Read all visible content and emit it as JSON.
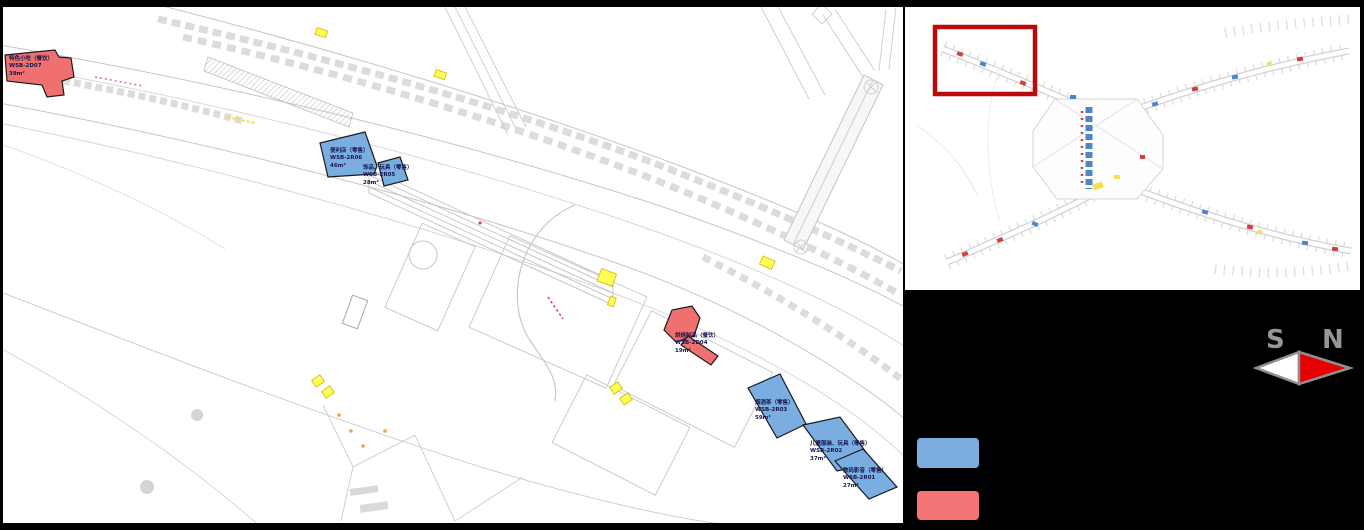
{
  "plan": {
    "shops": [
      {
        "name": "特色小吃（餐饮）",
        "code": "WSB-2D07",
        "area": "39m²",
        "category": "dining"
      },
      {
        "name": "便利店（零售）",
        "code": "WSB-2R06",
        "area": "46m²",
        "category": "retail"
      },
      {
        "name": "饰品、玩具（零售）",
        "code": "WSB-2R05",
        "area": "28m²",
        "category": "retail"
      },
      {
        "name": "烘焙制品（餐饮）",
        "code": "WSB-2D04",
        "area": "19m²",
        "category": "dining"
      },
      {
        "name": "烟酒茶（零售）",
        "code": "WSB-2R03",
        "area": "59m²",
        "category": "retail"
      },
      {
        "name": "儿童服装、玩具（零售）",
        "code": "WSB-2R02",
        "area": "37m²",
        "category": "retail"
      },
      {
        "name": "数码影音（零售）",
        "code": "WSB-2R01",
        "area": "27m²",
        "category": "retail"
      }
    ]
  },
  "compass": {
    "south_label": "S",
    "north_label": "N"
  },
  "legend": {
    "items": [
      {
        "key": "retail",
        "color": "#7BADDE"
      },
      {
        "key": "dining",
        "color": "#F17373"
      }
    ]
  },
  "colors": {
    "shop_blue": "#7AADE0",
    "shop_red": "#F07070",
    "highlight_yellow": "#FFFF55",
    "viewport_box": "#BB0A0A",
    "compass_red": "#E80000"
  }
}
